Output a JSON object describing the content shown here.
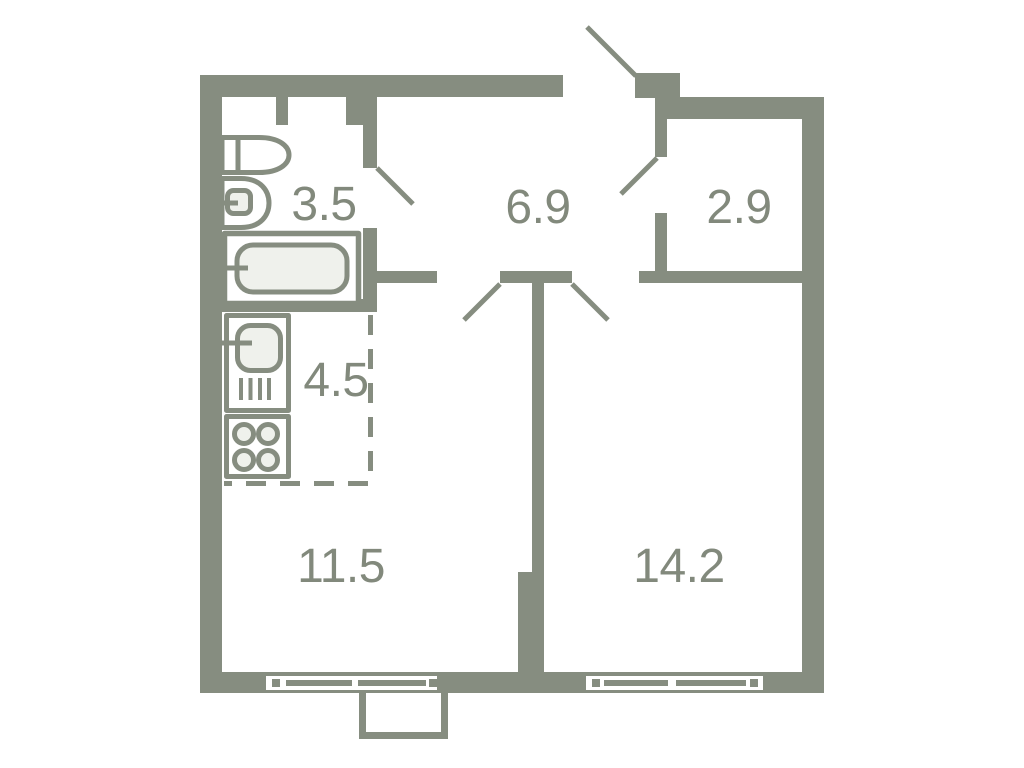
{
  "plan": {
    "kind": "apartment-floor-plan",
    "colors": {
      "wall": "#868D80",
      "label": "#82897C",
      "fixture_fill": "#EFF1EC",
      "background": "#FFFFFF"
    },
    "rooms": {
      "bathroom": {
        "area": "3.5"
      },
      "hallway": {
        "area": "6.9"
      },
      "storage": {
        "area": "2.9"
      },
      "kitchen": {
        "area": "4.5"
      },
      "living_room": {
        "area": "11.5"
      },
      "bedroom": {
        "area": "14.2"
      }
    },
    "fixtures": [
      "toilet",
      "washbasin",
      "bathtub",
      "kitchen-sink",
      "stove"
    ],
    "features": [
      "entrance-door",
      "bathroom-door",
      "storage-door",
      "living-room-door",
      "bedroom-door",
      "window-living-room",
      "window-bedroom",
      "balcony",
      "kitchen-zone-dashed-boundary",
      "vent-shaft-slots"
    ]
  }
}
